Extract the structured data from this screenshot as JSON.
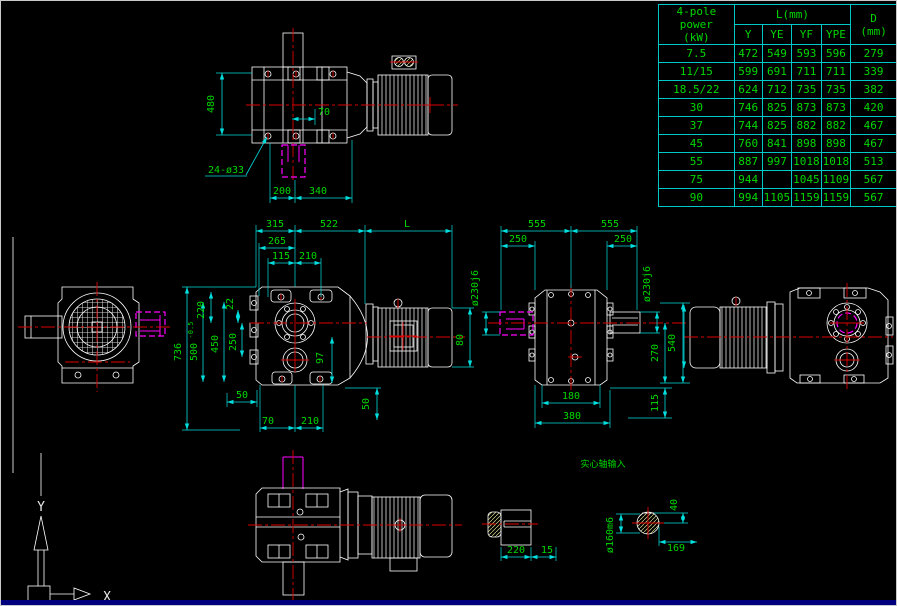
{
  "window": {
    "bg": "#000000",
    "frame": "#c9c9c9",
    "bottom_bar": "#00007e"
  },
  "colors": {
    "line": "#ffffff",
    "dimension": "#00dede",
    "dim_text": "#00d800",
    "centerline": "#dd0000",
    "hidden": "#ff00ff"
  },
  "table": {
    "power_header": "4-pole power",
    "power_unit": "(kW)",
    "l_header": "L(mm)",
    "sub": [
      "Y",
      "YE",
      "YF",
      "YPE"
    ],
    "d_header": "D",
    "d_unit": "(mm)",
    "rows": [
      {
        "power": "7.5",
        "y": "472",
        "ye": "549",
        "yf": "593",
        "ype": "596",
        "d": "279"
      },
      {
        "power": "11/15",
        "y": "599",
        "ye": "691",
        "yf": "711",
        "ype": "711",
        "d": "339"
      },
      {
        "power": "18.5/22",
        "y": "624",
        "ye": "712",
        "yf": "735",
        "ype": "735",
        "d": "382"
      },
      {
        "power": "30",
        "y": "746",
        "ye": "825",
        "yf": "873",
        "ype": "873",
        "d": "420"
      },
      {
        "power": "37",
        "y": "744",
        "ye": "825",
        "yf": "882",
        "ype": "882",
        "d": "467"
      },
      {
        "power": "45",
        "y": "760",
        "ye": "841",
        "yf": "898",
        "ype": "898",
        "d": "467"
      },
      {
        "power": "55",
        "y": "887",
        "ye": "997",
        "yf": "1018",
        "ype": "1018",
        "d": "513"
      },
      {
        "power": "75",
        "y": "944",
        "ye": "1045",
        "yf": "1109",
        "ype": "1109",
        "d": "567"
      },
      {
        "power": "90",
        "y": "994",
        "ye": "1105",
        "yf": "1159",
        "ype": "1159",
        "d": "567"
      }
    ]
  },
  "dims": {
    "side_top": {
      "h480": "480",
      "w70": "70",
      "holes": "24-ø33",
      "w200": "200",
      "w340": "340"
    },
    "front": {
      "w315": "315",
      "w522": "522",
      "wl": "L",
      "w265": "265",
      "w115": "115",
      "w210_top": "210",
      "h736": "736",
      "h500": "500",
      "h500_tol": "-0.5",
      "h450": "450",
      "h250": "250",
      "h220": "220",
      "h22": "22",
      "h97": "97",
      "h80": "80",
      "w50": "50",
      "w70": "70",
      "w210_bottom": "210",
      "h50": "50"
    },
    "plan": {
      "w555_left": "555",
      "w555_right": "555",
      "w250_left": "250",
      "w250_right": "250",
      "dia_left": "ø230j6",
      "dia_right": "ø230j6",
      "h540": "540",
      "h270": "270",
      "h115": "115",
      "w180": "180",
      "w380": "380"
    },
    "shaft": {
      "w220": "220",
      "w15": "15"
    },
    "section": {
      "h40": "40",
      "w169": "169",
      "dia": "ø160m6"
    },
    "note": "实心轴输入"
  },
  "ucs": {
    "x": "X",
    "y": "Y"
  }
}
